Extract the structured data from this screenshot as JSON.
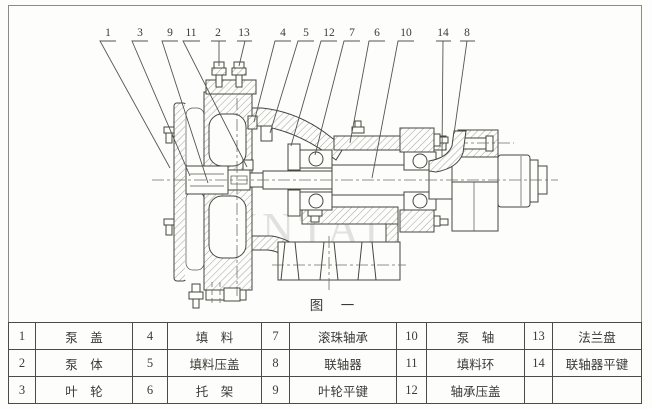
{
  "figure": {
    "caption": "图　一",
    "watermark": "JINTAI"
  },
  "callouts": [
    {
      "label": "1",
      "tx": 108,
      "leader": [
        [
          116,
          41
        ],
        [
          100,
          41
        ],
        [
          170,
          168
        ]
      ]
    },
    {
      "label": "3",
      "tx": 140,
      "leader": [
        [
          148,
          41
        ],
        [
          132,
          41
        ],
        [
          190,
          176
        ]
      ]
    },
    {
      "label": "9",
      "tx": 170,
      "leader": [
        [
          178,
          41
        ],
        [
          162,
          41
        ],
        [
          208,
          183
        ]
      ]
    },
    {
      "label": "11",
      "tx": 191,
      "leader": [
        [
          200,
          41
        ],
        [
          183,
          41
        ],
        [
          247,
          167
        ]
      ]
    },
    {
      "label": "2",
      "tx": 218,
      "leader": [
        [
          211,
          41
        ],
        [
          226,
          41
        ],
        [
          219,
          41
        ],
        [
          219,
          66
        ]
      ]
    },
    {
      "label": "13",
      "tx": 244,
      "leader": [
        [
          237,
          41
        ],
        [
          252,
          41
        ],
        [
          245,
          41
        ],
        [
          239,
          66
        ]
      ]
    },
    {
      "label": "4",
      "tx": 283,
      "leader": [
        [
          291,
          41
        ],
        [
          275,
          41
        ],
        [
          254,
          122
        ]
      ]
    },
    {
      "label": "5",
      "tx": 306,
      "leader": [
        [
          314,
          41
        ],
        [
          298,
          41
        ],
        [
          270,
          133
        ]
      ]
    },
    {
      "label": "12",
      "tx": 329,
      "leader": [
        [
          337,
          41
        ],
        [
          321,
          41
        ],
        [
          291,
          146
        ]
      ]
    },
    {
      "label": "7",
      "tx": 352,
      "leader": [
        [
          360,
          41
        ],
        [
          344,
          41
        ],
        [
          315,
          155
        ]
      ]
    },
    {
      "label": "6",
      "tx": 377,
      "leader": [
        [
          385,
          41
        ],
        [
          369,
          41
        ],
        [
          350,
          143
        ]
      ]
    },
    {
      "label": "10",
      "tx": 406,
      "leader": [
        [
          414,
          41
        ],
        [
          398,
          41
        ],
        [
          372,
          178
        ]
      ]
    },
    {
      "label": "14",
      "tx": 443,
      "leader": [
        [
          436,
          41
        ],
        [
          451,
          41
        ],
        [
          443,
          41
        ],
        [
          442,
          156
        ]
      ]
    },
    {
      "label": "8",
      "tx": 467,
      "leader": [
        [
          460,
          41
        ],
        [
          475,
          41
        ],
        [
          467,
          41
        ],
        [
          454,
          134
        ]
      ]
    }
  ],
  "parts_table": {
    "rows": [
      [
        {
          "num": "1",
          "name": "泵　盖"
        },
        {
          "num": "4",
          "name": "填　料"
        },
        {
          "num": "7",
          "name": "滚珠轴承"
        },
        {
          "num": "10",
          "name": "泵　轴"
        },
        {
          "num": "13",
          "name": "法兰盘"
        }
      ],
      [
        {
          "num": "2",
          "name": "泵　体"
        },
        {
          "num": "5",
          "name": "填料压盖"
        },
        {
          "num": "8",
          "name": "联轴器"
        },
        {
          "num": "11",
          "name": "填料环"
        },
        {
          "num": "14",
          "name": "联轴器平键"
        }
      ],
      [
        {
          "num": "3",
          "name": "叶　轮"
        },
        {
          "num": "6",
          "name": "托　架"
        },
        {
          "num": "9",
          "name": "叶轮平键"
        },
        {
          "num": "12",
          "name": "轴承压盖"
        },
        {
          "num": "",
          "name": ""
        }
      ]
    ]
  },
  "colors": {
    "ink": "#46463f",
    "hatch": "#63635b",
    "frame": "#8d8b85",
    "watermark": "#cbccc5",
    "paper": "#fdfdfb"
  }
}
